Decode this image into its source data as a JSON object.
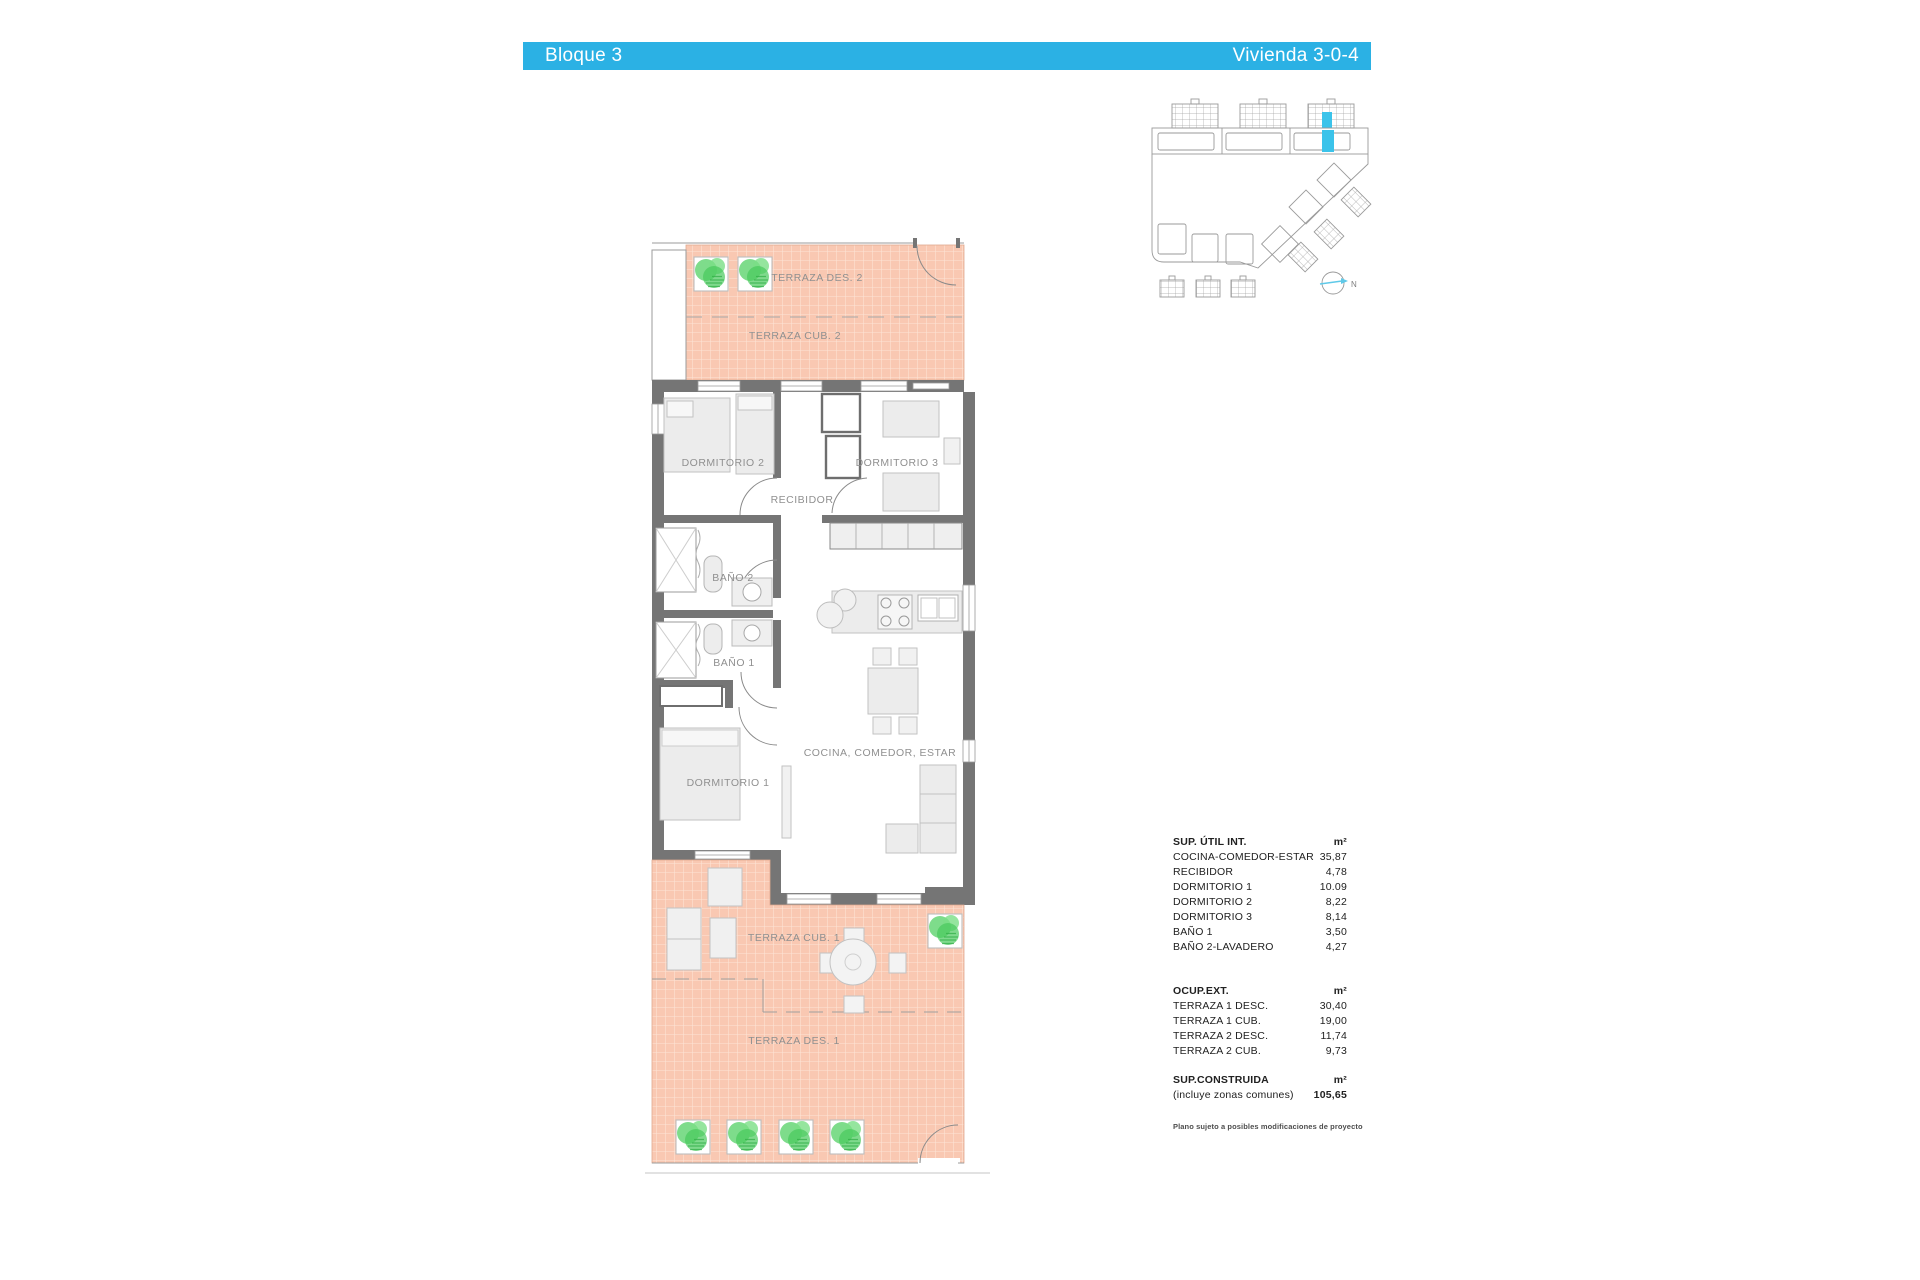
{
  "header": {
    "block": "Bloque 3",
    "unit": "Vivienda 3-0-4",
    "bg_color": "#2bb1e4"
  },
  "site_plan": {
    "north_label": "N",
    "highlight_color": "#3bc3ea"
  },
  "floor_plan": {
    "labels": {
      "terraza_des_2": "TERRAZA DES. 2",
      "terraza_cub_2": "TERRAZA CUB. 2",
      "dormitorio_2": "DORMITORIO 2",
      "dormitorio_3": "DORMITORIO 3",
      "recibidor": "RECIBIDOR",
      "bano_2": "BAÑO 2",
      "bano_1": "BAÑO 1",
      "dormitorio_1": "DORMITORIO 1",
      "cocina_comedor_estar": "COCINA, COMEDOR, ESTAR",
      "terraza_cub_1": "TERRAZA CUB. 1",
      "terraza_des_1": "TERRAZA DES. 1"
    },
    "terrace_color": "#f9c8b2",
    "wall_color": "#757575",
    "plant_color": "#5ed36e"
  },
  "areas_table": {
    "interior": {
      "title": "SUP. ÚTIL INT.",
      "unit": "m²",
      "rows": [
        {
          "label": "COCINA-COMEDOR-ESTAR",
          "value": "35,87"
        },
        {
          "label": "RECIBIDOR",
          "value": "4,78"
        },
        {
          "label": "DORMITORIO 1",
          "value": "10.09"
        },
        {
          "label": "DORMITORIO 2",
          "value": "8,22"
        },
        {
          "label": "DORMITORIO 3",
          "value": "8,14"
        },
        {
          "label": "BAÑO 1",
          "value": "3,50"
        },
        {
          "label": "BAÑO 2-LAVADERO",
          "value": "4,27"
        }
      ]
    },
    "exterior": {
      "title": "OCUP.EXT.",
      "unit": "m²",
      "rows": [
        {
          "label": "TERRAZA 1 DESC.",
          "value": "30,40"
        },
        {
          "label": "TERRAZA 1 CUB.",
          "value": "19,00"
        },
        {
          "label": "TERRAZA 2 DESC.",
          "value": "11,74"
        },
        {
          "label": "TERRAZA 2 CUB.",
          "value": "9,73"
        }
      ]
    },
    "built": {
      "title": "SUP.CONSTRUIDA",
      "unit": "m²",
      "subtitle": "(incluye zonas comunes)",
      "value": "105,65"
    },
    "footnote": "Plano sujeto a posibles modificaciones de proyecto"
  }
}
